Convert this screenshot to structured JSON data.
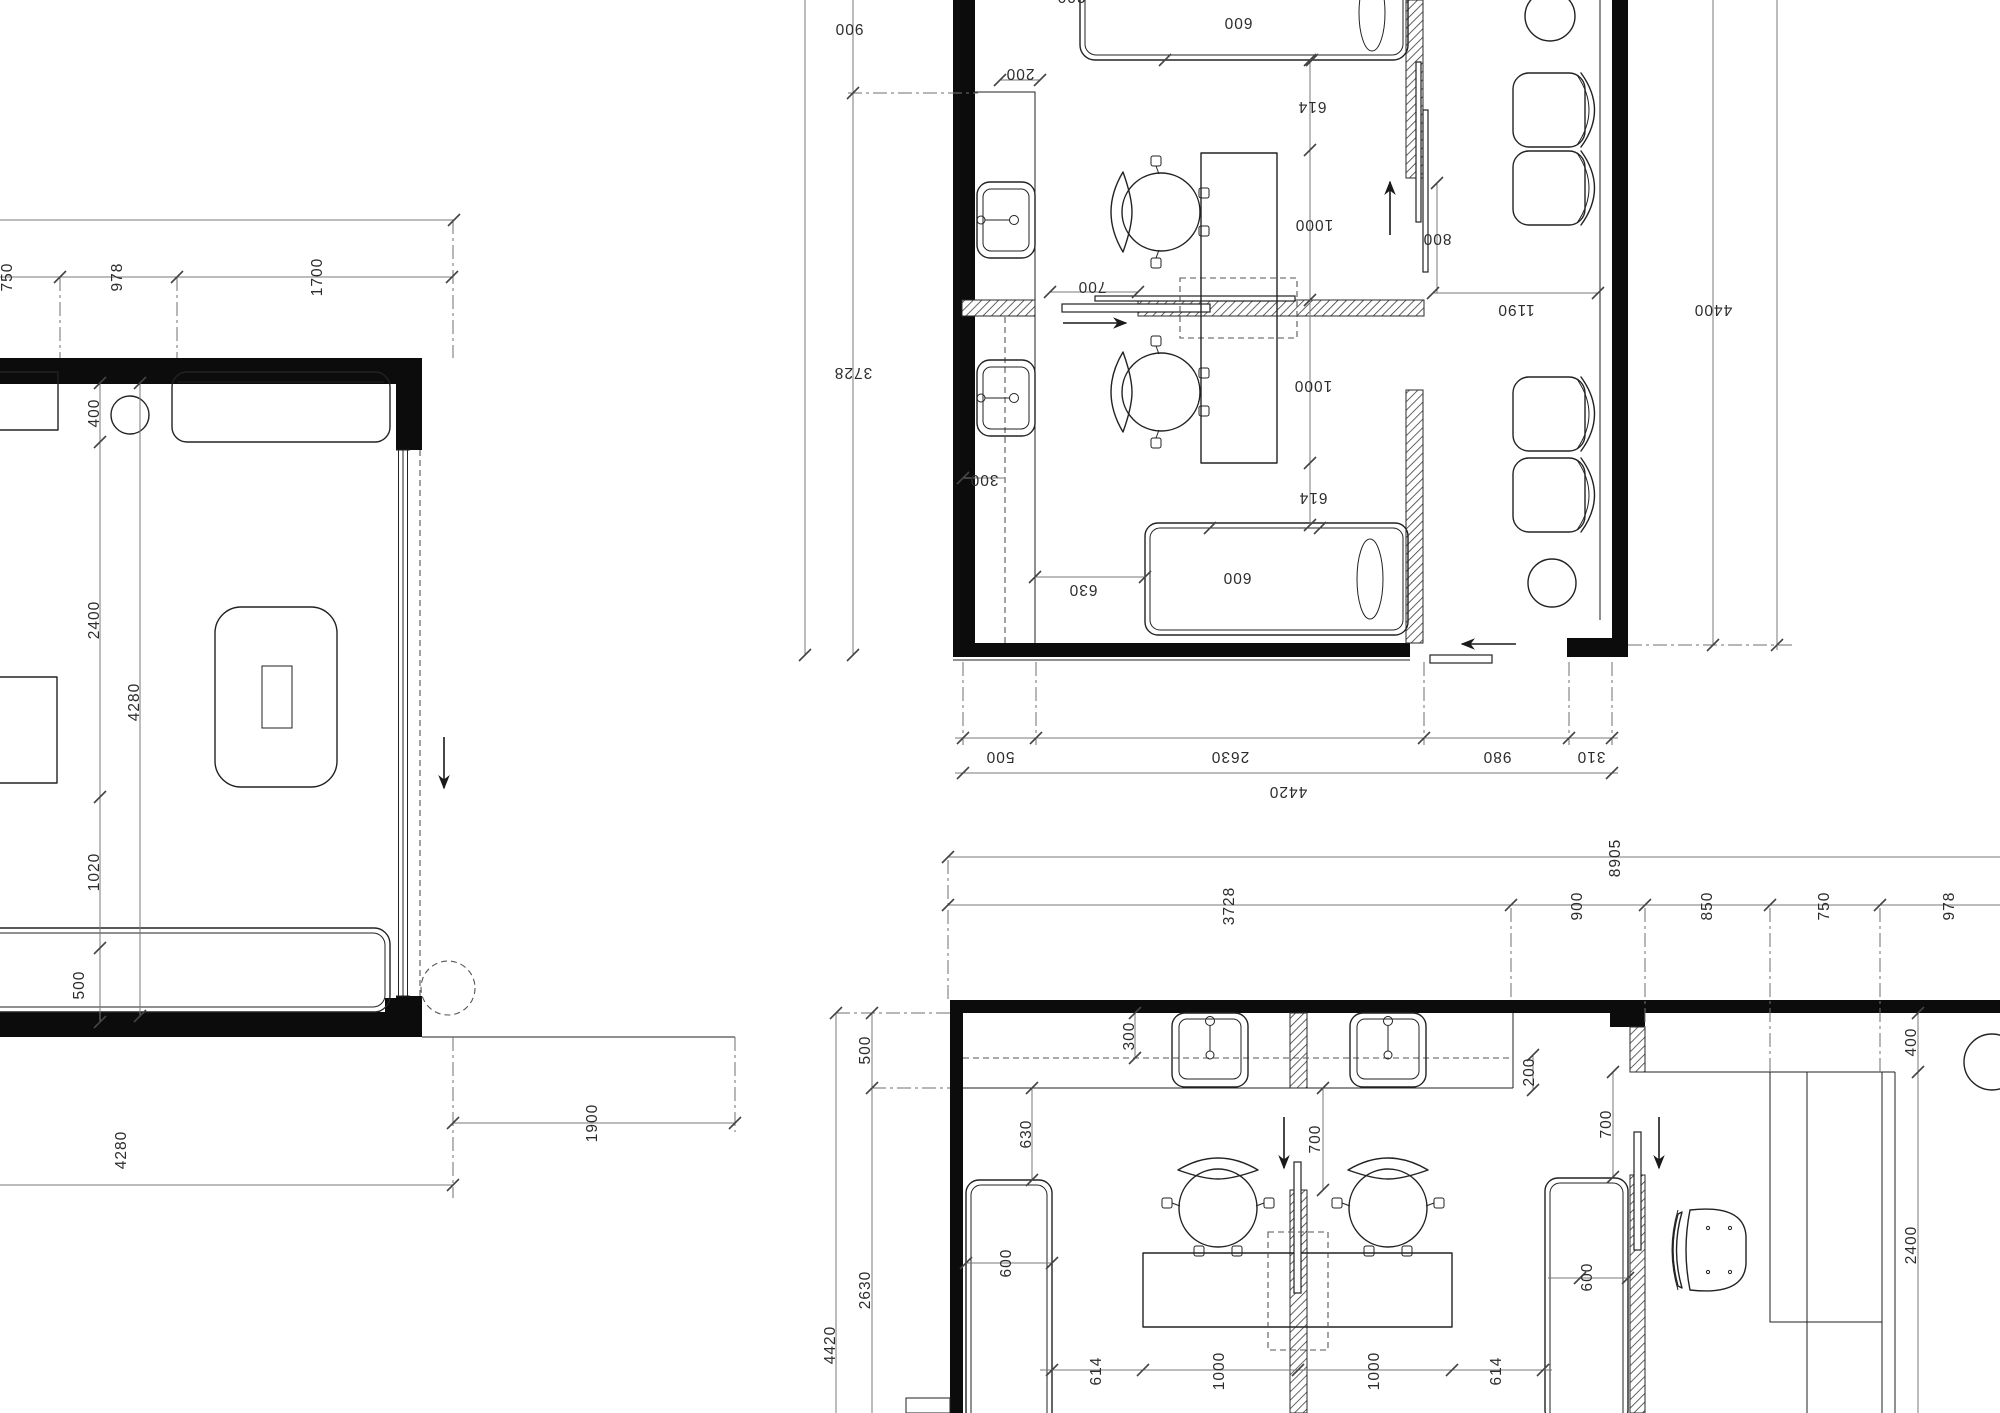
{
  "drawing": {
    "type": "architectural-floor-plan",
    "line_color": "#222222",
    "wall_color": "#0c0c0c",
    "dim_color": "#2c2c2c",
    "background": "#ffffff"
  },
  "plans": {
    "left": {
      "label": "partial-room-plan",
      "dims": [
        {
          "t": "750",
          "x": 8,
          "y": 277,
          "r": -90
        },
        {
          "t": "978",
          "x": 118,
          "y": 277,
          "r": -90
        },
        {
          "t": "1700",
          "x": 318,
          "y": 277,
          "r": -90
        },
        {
          "t": "400",
          "x": 95,
          "y": 413,
          "r": -90
        },
        {
          "t": "2400",
          "x": 95,
          "y": 620,
          "r": -90
        },
        {
          "t": "1020",
          "x": 95,
          "y": 872,
          "r": -90
        },
        {
          "t": "500",
          "x": 80,
          "y": 985,
          "r": -90
        },
        {
          "t": "4280",
          "x": 135,
          "y": 702,
          "r": -90
        },
        {
          "t": "4280",
          "x": 122,
          "y": 1150,
          "r": -90
        },
        {
          "t": "1900",
          "x": 593,
          "y": 1123,
          "r": -90
        }
      ]
    },
    "top_right": {
      "label": "salon-room-plan-rotated-180",
      "dims": [
        {
          "t": "200",
          "x": 1071,
          "y": -4,
          "r": 180
        },
        {
          "t": "900",
          "x": 849,
          "y": 28,
          "r": 180
        },
        {
          "t": "600",
          "x": 1238,
          "y": 22,
          "r": 180
        },
        {
          "t": "200",
          "x": 1020,
          "y": 73,
          "r": 180
        },
        {
          "t": "614",
          "x": 1312,
          "y": 106,
          "r": 180
        },
        {
          "t": "1000",
          "x": 1314,
          "y": 224,
          "r": 180
        },
        {
          "t": "700",
          "x": 1092,
          "y": 286,
          "r": 180
        },
        {
          "t": "800",
          "x": 1437,
          "y": 238,
          "r": 180
        },
        {
          "t": "1190",
          "x": 1516,
          "y": 309,
          "r": 180
        },
        {
          "t": "4400",
          "x": 1713,
          "y": 309,
          "r": 180
        },
        {
          "t": "3728",
          "x": 853,
          "y": 372,
          "r": 180
        },
        {
          "t": "1000",
          "x": 1313,
          "y": 385,
          "r": 180
        },
        {
          "t": "300",
          "x": 984,
          "y": 479,
          "r": 180
        },
        {
          "t": "614",
          "x": 1313,
          "y": 497,
          "r": 180
        },
        {
          "t": "630",
          "x": 1083,
          "y": 589,
          "r": 180
        },
        {
          "t": "600",
          "x": 1237,
          "y": 577,
          "r": 180
        },
        {
          "t": "500",
          "x": 1000,
          "y": 756,
          "r": 180
        },
        {
          "t": "2630",
          "x": 1230,
          "y": 756,
          "r": 180
        },
        {
          "t": "980",
          "x": 1497,
          "y": 756,
          "r": 180
        },
        {
          "t": "310",
          "x": 1591,
          "y": 756,
          "r": 180
        },
        {
          "t": "4420",
          "x": 1288,
          "y": 791,
          "r": 180
        }
      ]
    },
    "bottom": {
      "label": "overall-salon-plan",
      "dims": [
        {
          "t": "8905",
          "x": 1616,
          "y": 858,
          "r": -90
        },
        {
          "t": "3728",
          "x": 1230,
          "y": 906,
          "r": -90
        },
        {
          "t": "900",
          "x": 1578,
          "y": 906,
          "r": -90
        },
        {
          "t": "850",
          "x": 1708,
          "y": 906,
          "r": -90
        },
        {
          "t": "750",
          "x": 1825,
          "y": 906,
          "r": -90
        },
        {
          "t": "978",
          "x": 1950,
          "y": 906,
          "r": -90
        },
        {
          "t": "500",
          "x": 866,
          "y": 1050,
          "r": -90
        },
        {
          "t": "2630",
          "x": 866,
          "y": 1290,
          "r": -90
        },
        {
          "t": "4420",
          "x": 831,
          "y": 1345,
          "r": -90
        },
        {
          "t": "300",
          "x": 1130,
          "y": 1036,
          "r": -90
        },
        {
          "t": "200",
          "x": 1530,
          "y": 1072,
          "r": -90
        },
        {
          "t": "630",
          "x": 1027,
          "y": 1134,
          "r": -90
        },
        {
          "t": "600",
          "x": 1007,
          "y": 1263,
          "r": -90
        },
        {
          "t": "700",
          "x": 1316,
          "y": 1139,
          "r": -90
        },
        {
          "t": "700",
          "x": 1607,
          "y": 1124,
          "r": -90
        },
        {
          "t": "400",
          "x": 1912,
          "y": 1042,
          "r": -90
        },
        {
          "t": "2400",
          "x": 1912,
          "y": 1245,
          "r": -90
        },
        {
          "t": "600",
          "x": 1588,
          "y": 1277,
          "r": -90
        },
        {
          "t": "614",
          "x": 1097,
          "y": 1371,
          "r": -90
        },
        {
          "t": "1000",
          "x": 1220,
          "y": 1371,
          "r": -90
        },
        {
          "t": "1000",
          "x": 1375,
          "y": 1371,
          "r": -90
        },
        {
          "t": "614",
          "x": 1497,
          "y": 1371,
          "r": -90
        }
      ]
    }
  }
}
